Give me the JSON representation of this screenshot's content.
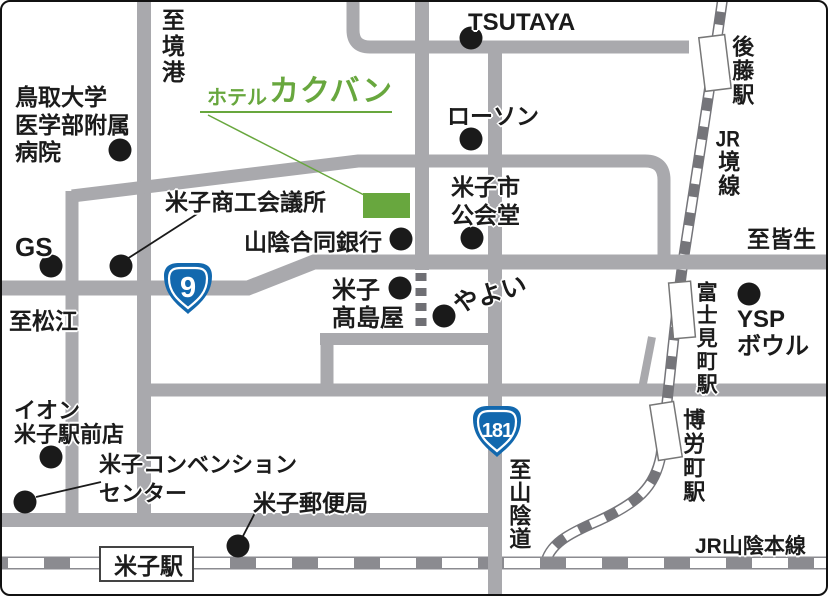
{
  "map_title": {
    "hotel_prefix": "ホテル",
    "hotel_name": "カクバン"
  },
  "badges": {
    "route9": "9",
    "route181": "181"
  },
  "colors": {
    "road_gray": "#a9a9ad",
    "rail_sakai_dark": "#75757a",
    "rail_main_dark": "#8b8b90",
    "accent_green": "#68a73e",
    "route_badge_blue": "#1268ae",
    "poi_dot_black": "#1a1a1a"
  },
  "labels": {
    "to_sakaiminato": "至境港",
    "hospital": [
      "鳥取大学",
      "医学部附属",
      "病院"
    ],
    "tsutaya": "TSUTAYA",
    "lawson": "ローソン",
    "goto_station": "後藤駅",
    "jr_prefix": "JR",
    "sakai_line": "境線",
    "chamber_of_commerce": "米子商工会議所",
    "public_hall": [
      "米子市",
      "公会堂"
    ],
    "bank": "山陰合同銀行",
    "gs": "GS",
    "to_matsue": "至松江",
    "to_kaike": "至皆生",
    "takashimaya": [
      "米子",
      "髙島屋"
    ],
    "yayoi": "やよい",
    "fujimicho_station": "富士見町駅",
    "ysp": [
      "YSP",
      "ボウル"
    ],
    "to_sanindo": "至山陰道",
    "aeon": [
      "イオン",
      "米子駅前店"
    ],
    "convention_center": [
      "米子コンベンション",
      "センター"
    ],
    "post_office": "米子郵便局",
    "yonago_station": "米子駅",
    "jr_sanin_main_line": "JR山陰本線"
  }
}
